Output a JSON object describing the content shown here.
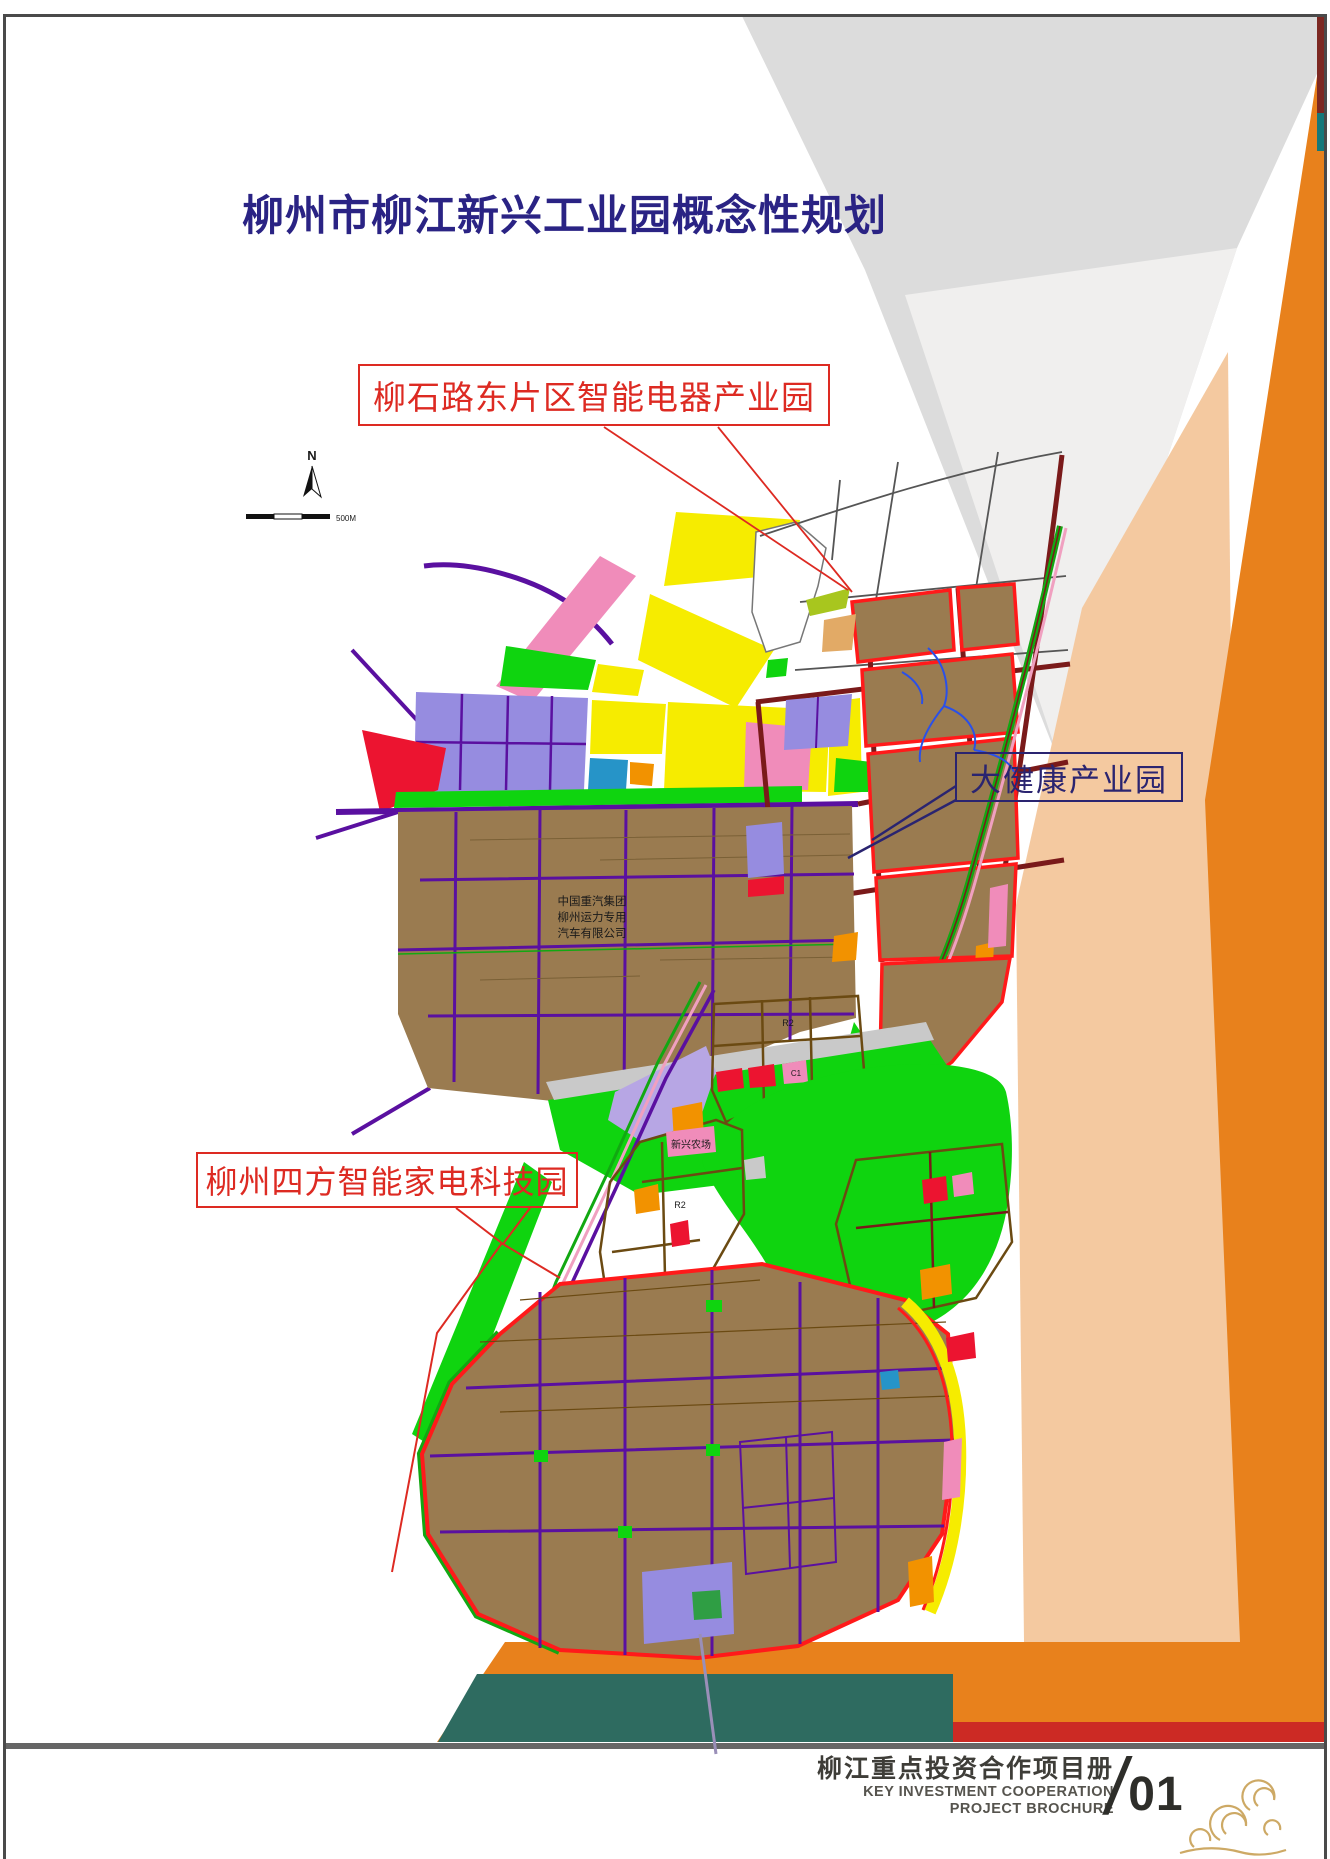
{
  "page_title": "柳州市柳江新兴工业园概念性规划",
  "labels": {
    "east": "柳石路东片区智能电器产业园",
    "health": "大健康产业园",
    "sifang": "柳州四方智能家电科技园"
  },
  "map": {
    "compass_n": "N",
    "scale_label": "500M",
    "zone_codes": [
      "R2",
      "C1"
    ],
    "annotations": {
      "company": "中国重汽集团柳州运力专用汽车有限公司",
      "company_lines": [
        "中国重汽集团",
        "柳州运力专用",
        "汽车有限公司"
      ],
      "farm": "新兴农场"
    }
  },
  "footer": {
    "title_cn": "柳江重点投资合作项目册",
    "en_line1": "KEY INVESTMENT COOPERATION",
    "en_line2": "PROJECT BROCHURE",
    "slash": "/",
    "page_number": "01"
  },
  "colors": {
    "title_navy": "#2a2384",
    "label_red": "#dd2a22",
    "label_navy": "#2a2470",
    "deco_gray": "#dcdcdc",
    "deco_gray_light": "#f0efee",
    "deco_orange": "#e8811c",
    "deco_peach": "#f4c9a0",
    "deco_teal": "#2e6b60",
    "deco_red": "#cc2a24",
    "ribbon_maroon": "#7c2822",
    "ribbon_teal": "#15787a",
    "frame_gray": "#4a4a4a",
    "footer_text": "#3e3d38",
    "footer_text_light": "#56544e",
    "pagenum_dark": "#2e2e2a",
    "gold": "#c8a055",
    "map_yellow": "#f6ec00",
    "map_brown": "#9a7b50",
    "map_green": "#0fd40f",
    "map_green_dark": "#2f9e44",
    "map_lavender": "#968ce0",
    "map_pond": "#b7a6e4",
    "map_pink": "#f08cba",
    "map_red": "#ec1430",
    "map_orange": "#f29200",
    "map_teal": "#2694c8",
    "map_lime": "#a8c61e",
    "map_tan": "#e2aa66",
    "map_gray": "#c9c9c9",
    "road_purple": "#5a10a0",
    "road_darkred": "#7a1a1a",
    "road_brown": "#6b4a12",
    "road_green": "#12a812",
    "boundary_red": "#ff1a1a",
    "rail_pink": "#f0a0c0",
    "stream_blue": "#2a50e8"
  }
}
